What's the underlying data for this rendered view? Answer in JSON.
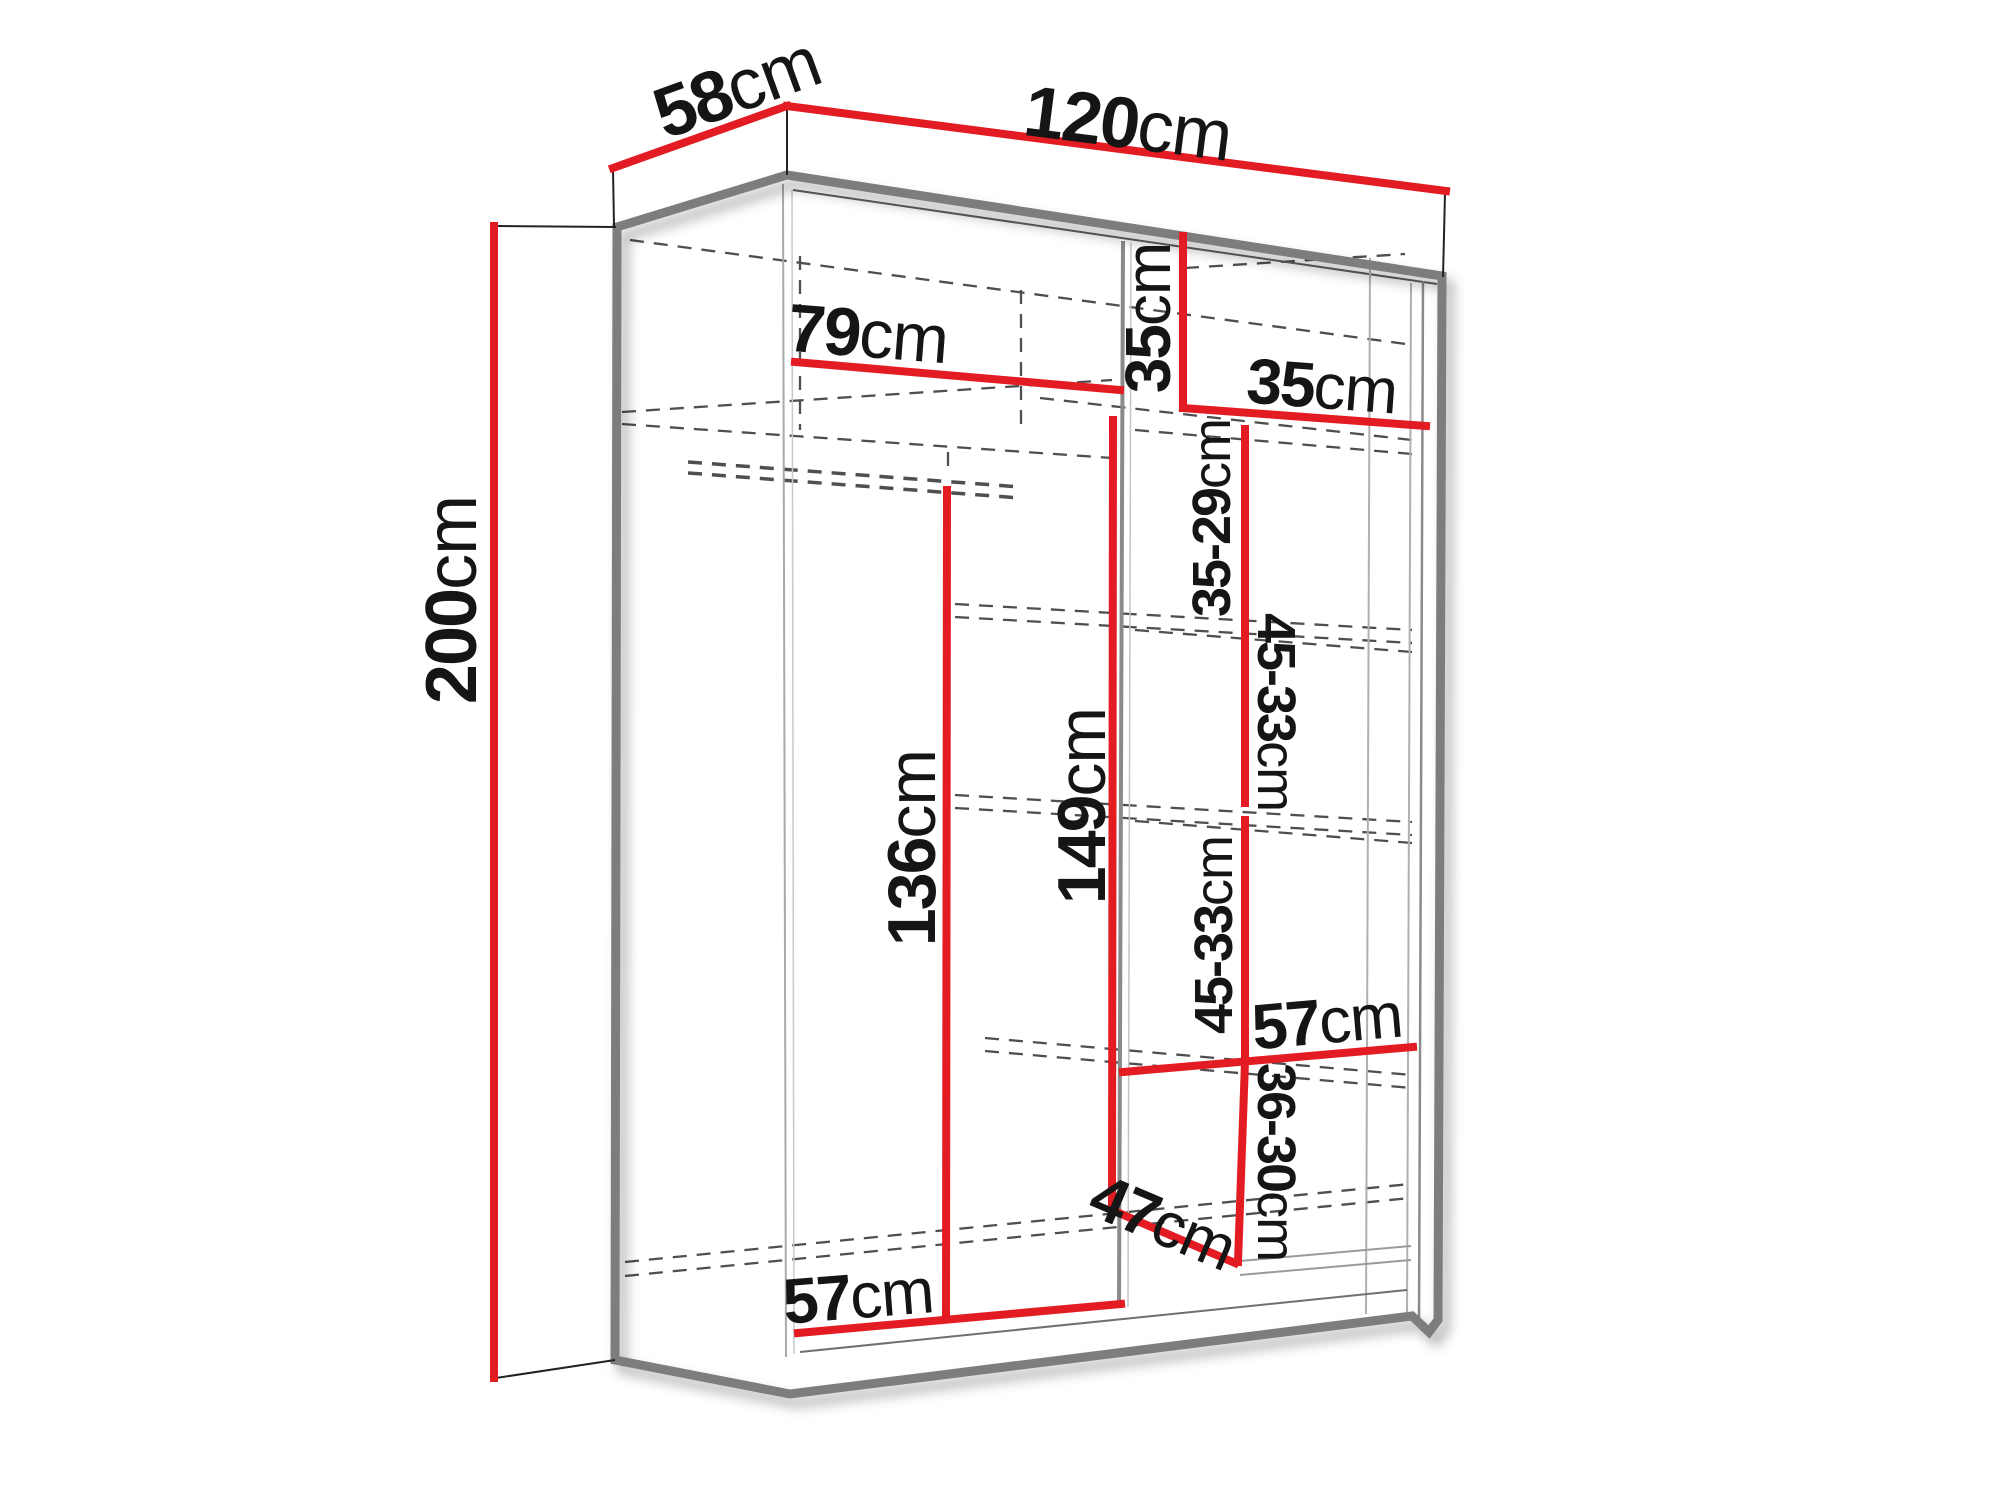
{
  "page": {
    "background": "#ffffff"
  },
  "diagram": {
    "name": "wardrobe-sliding-door-dimension-diagram",
    "unit": "cm",
    "colors": {
      "dimension_line": "#e31b22",
      "outline": "#7d7d7d",
      "thin_line": "#9a9a9a",
      "dashed_line": "#4f4f4f",
      "text": "#151515",
      "background": "#ffffff"
    },
    "overall_dimensions": {
      "width": "120cm",
      "depth": "58cm",
      "height": "200cm"
    },
    "labels": [
      {
        "id": "depth-label",
        "value": "58",
        "unit": "cm",
        "x": 737,
        "y": 88,
        "rotate": -20,
        "size": 72
      },
      {
        "id": "width-label",
        "value": "120",
        "unit": "cm",
        "x": 1128,
        "y": 124,
        "rotate": 7.3,
        "size": 72
      },
      {
        "id": "height-label",
        "value": "200",
        "unit": "cm",
        "x": 452,
        "y": 600,
        "rotate": -90,
        "size": 72
      },
      {
        "id": "left-inner-width-label",
        "value": "79",
        "unit": "cm",
        "x": 868,
        "y": 334,
        "rotate": 4.5,
        "size": 68
      },
      {
        "id": "top-shelf-height-label",
        "value": "35",
        "unit": "cm",
        "x": 1148,
        "y": 318,
        "rotate": -90,
        "size": 64
      },
      {
        "id": "top-shelf-width-label",
        "value": "35",
        "unit": "cm",
        "x": 1322,
        "y": 386,
        "rotate": 4.3,
        "size": 64
      },
      {
        "id": "section-1-label",
        "value": "35-29",
        "unit": "cm",
        "x": 1212,
        "y": 518,
        "rotate": -90,
        "size": 54
      },
      {
        "id": "section-2-label",
        "value": "45-33",
        "unit": "cm",
        "x": 1276,
        "y": 712,
        "rotate": 90,
        "size": 54
      },
      {
        "id": "section-3-label",
        "value": "45-33",
        "unit": "cm",
        "x": 1214,
        "y": 935,
        "rotate": -90,
        "size": 54
      },
      {
        "id": "section-4-label",
        "value": "36-30",
        "unit": "cm",
        "x": 1276,
        "y": 1162,
        "rotate": 90,
        "size": 54
      },
      {
        "id": "left-height-label",
        "value": "136",
        "unit": "cm",
        "x": 912,
        "y": 848,
        "rotate": -90,
        "size": 68
      },
      {
        "id": "middle-height-label",
        "value": "149",
        "unit": "cm",
        "x": 1082,
        "y": 806,
        "rotate": -90,
        "size": 68
      },
      {
        "id": "shelf-width-label",
        "value": "57",
        "unit": "cm",
        "x": 1327,
        "y": 1021,
        "rotate": -5,
        "size": 64
      },
      {
        "id": "bottom-depth-label",
        "value": "47",
        "unit": "cm",
        "x": 1163,
        "y": 1222,
        "rotate": 23,
        "size": 64
      },
      {
        "id": "bottom-width-label",
        "value": "57",
        "unit": "cm",
        "x": 858,
        "y": 1296,
        "rotate": -4.5,
        "size": 64
      }
    ],
    "outline_path": "M617,227 L787,175 L1442,276 L1438,1320 L1429,1332 L1412,1316 L790,1394 L615,1360 Z",
    "red_lines": [
      {
        "id": "depth-line",
        "pts": [
          613,
          168,
          787,
          106
        ]
      },
      {
        "id": "width-line",
        "pts": [
          787,
          106,
          1446,
          191
        ]
      },
      {
        "id": "height-line",
        "pts": [
          494,
          226,
          494,
          1378
        ]
      },
      {
        "id": "left-inner-width-line",
        "pts": [
          795,
          362,
          1120,
          390
        ]
      },
      {
        "id": "top-shelf-height-line",
        "pts": [
          1183,
          236,
          1183,
          408
        ]
      },
      {
        "id": "top-shelf-width-line",
        "pts": [
          1183,
          408,
          1426,
          426
        ]
      },
      {
        "id": "middle-height-line",
        "pts": [
          1113,
          420,
          1112,
          1210
        ]
      },
      {
        "id": "left-height-line",
        "pts": [
          947,
          490,
          946,
          1316
        ]
      },
      {
        "id": "section-1-line",
        "pts": [
          1245,
          429,
          1245,
          615
        ]
      },
      {
        "id": "section-2-line",
        "pts": [
          1245,
          622,
          1245,
          803
        ]
      },
      {
        "id": "section-3-line",
        "pts": [
          1245,
          820,
          1245,
          1055
        ]
      },
      {
        "id": "shelf-width-line",
        "pts": [
          1123,
          1072,
          1413,
          1047
        ]
      },
      {
        "id": "section-4-line",
        "pts": [
          1245,
          1062,
          1238,
          1262
        ]
      },
      {
        "id": "bottom-depth-line",
        "pts": [
          1112,
          1210,
          1235,
          1263
        ]
      },
      {
        "id": "bottom-width-line",
        "pts": [
          798,
          1333,
          1121,
          1304
        ]
      }
    ],
    "extension_lines": [
      {
        "id": "ext-depth-left",
        "pts": [
          613,
          170,
          614,
          226
        ]
      },
      {
        "id": "ext-top-corner",
        "pts": [
          787,
          108,
          787,
          175
        ]
      },
      {
        "id": "ext-width-right",
        "pts": [
          1445,
          193,
          1443,
          277
        ]
      },
      {
        "id": "ext-height-top",
        "pts": [
          496,
          226,
          616,
          227
        ]
      },
      {
        "id": "ext-height-bottom",
        "pts": [
          496,
          1378,
          615,
          1360
        ]
      }
    ],
    "thin_lines": [
      {
        "id": "top-slab-underside",
        "pts": [
          793,
          190,
          1437,
          284
        ],
        "w": 2,
        "c": "#5f5f5f"
      },
      {
        "id": "left-wall-inner-a",
        "pts": [
          783,
          184,
          786,
          1357
        ],
        "w": 2,
        "c": "#a9a9a9"
      },
      {
        "id": "left-wall-inner-b",
        "pts": [
          792,
          190,
          794,
          1354
        ],
        "w": 1.5,
        "c": "#c9c9c9"
      },
      {
        "id": "middle-divider",
        "pts": [
          1123,
          241,
          1119,
          1307
        ],
        "w": 4,
        "c": "#8a8a8a"
      },
      {
        "id": "middle-divider-edge",
        "pts": [
          1131,
          243,
          1128,
          1307
        ],
        "w": 1.5,
        "c": "#c4c4c4"
      },
      {
        "id": "right-door-edge",
        "pts": [
          1370,
          258,
          1366,
          1314
        ],
        "w": 2,
        "c": "#b0b0b0"
      },
      {
        "id": "right-wall-inner-a",
        "pts": [
          1411,
          283,
          1407,
          1320
        ],
        "w": 2,
        "c": "#b0b0b0"
      },
      {
        "id": "right-wall-inner-b",
        "pts": [
          1423,
          281,
          1419,
          1322
        ],
        "w": 2.5,
        "c": "#8a8a8a"
      },
      {
        "id": "floor-front-edge",
        "pts": [
          800,
          1352,
          1407,
          1290
        ],
        "w": 2,
        "c": "#6f6f6f"
      },
      {
        "id": "bottom-shelf-top",
        "pts": [
          1240,
          1261,
          1411,
          1246
        ],
        "w": 2,
        "c": "#9a9a9a"
      },
      {
        "id": "bottom-shelf-bottom",
        "pts": [
          1240,
          1275,
          1411,
          1260
        ],
        "w": 2,
        "c": "#9a9a9a"
      }
    ],
    "dashed_lines": [
      {
        "id": "interior-top-back",
        "pts": [
          630,
          240,
          1406,
          344
        ],
        "w": 2.3
      },
      {
        "id": "interior-back-corner",
        "pts": [
          800,
          256,
          800,
          430
        ],
        "w": 2.3
      },
      {
        "id": "divider-back-edge",
        "pts": [
          1021,
          290,
          1021,
          425
        ],
        "w": 2.3
      },
      {
        "id": "top-right-depth",
        "pts": [
          1185,
          268,
          1405,
          254
        ],
        "w": 2.3
      },
      {
        "id": "left-shelf-back",
        "pts": [
          622,
          412,
          1112,
          380
        ],
        "w": 2.3
      },
      {
        "id": "left-shelf-front",
        "pts": [
          622,
          424,
          1112,
          458
        ],
        "w": 2.3
      },
      {
        "id": "hanging-rail-top",
        "pts": [
          688,
          462,
          1020,
          487
        ],
        "w": 3.5
      },
      {
        "id": "hanging-rail-bottom",
        "pts": [
          688,
          473,
          1020,
          498
        ],
        "w": 3.5
      },
      {
        "id": "hanging-rail-hanger",
        "pts": [
          948,
          452,
          948,
          473
        ],
        "w": 2.3
      },
      {
        "id": "shelf-1-a",
        "pts": [
          1040,
          398,
          1412,
          440
        ],
        "w": 2.3
      },
      {
        "id": "shelf-1-b",
        "pts": [
          1135,
          430,
          1412,
          454
        ],
        "w": 2.3
      },
      {
        "id": "shelf-2-a",
        "pts": [
          955,
          604,
          1412,
          630
        ],
        "w": 2.3
      },
      {
        "id": "shelf-2-b",
        "pts": [
          955,
          617,
          1412,
          643
        ],
        "w": 2.3
      },
      {
        "id": "shelf-2-c",
        "pts": [
          1135,
          630,
          1412,
          652
        ],
        "w": 2.3
      },
      {
        "id": "shelf-3-a",
        "pts": [
          955,
          795,
          1412,
          822
        ],
        "w": 2.3
      },
      {
        "id": "shelf-3-b",
        "pts": [
          955,
          808,
          1412,
          835
        ],
        "w": 2.3
      },
      {
        "id": "shelf-3-c",
        "pts": [
          1135,
          821,
          1412,
          843
        ],
        "w": 2.3
      },
      {
        "id": "shelf-4-a",
        "pts": [
          985,
          1038,
          1412,
          1075
        ],
        "w": 2.3
      },
      {
        "id": "shelf-4-b",
        "pts": [
          985,
          1051,
          1412,
          1088
        ],
        "w": 2.3
      },
      {
        "id": "floor-a",
        "pts": [
          625,
          1262,
          1410,
          1184
        ],
        "w": 2.3
      },
      {
        "id": "floor-b",
        "pts": [
          625,
          1276,
          1410,
          1198
        ],
        "w": 2.3
      }
    ]
  }
}
